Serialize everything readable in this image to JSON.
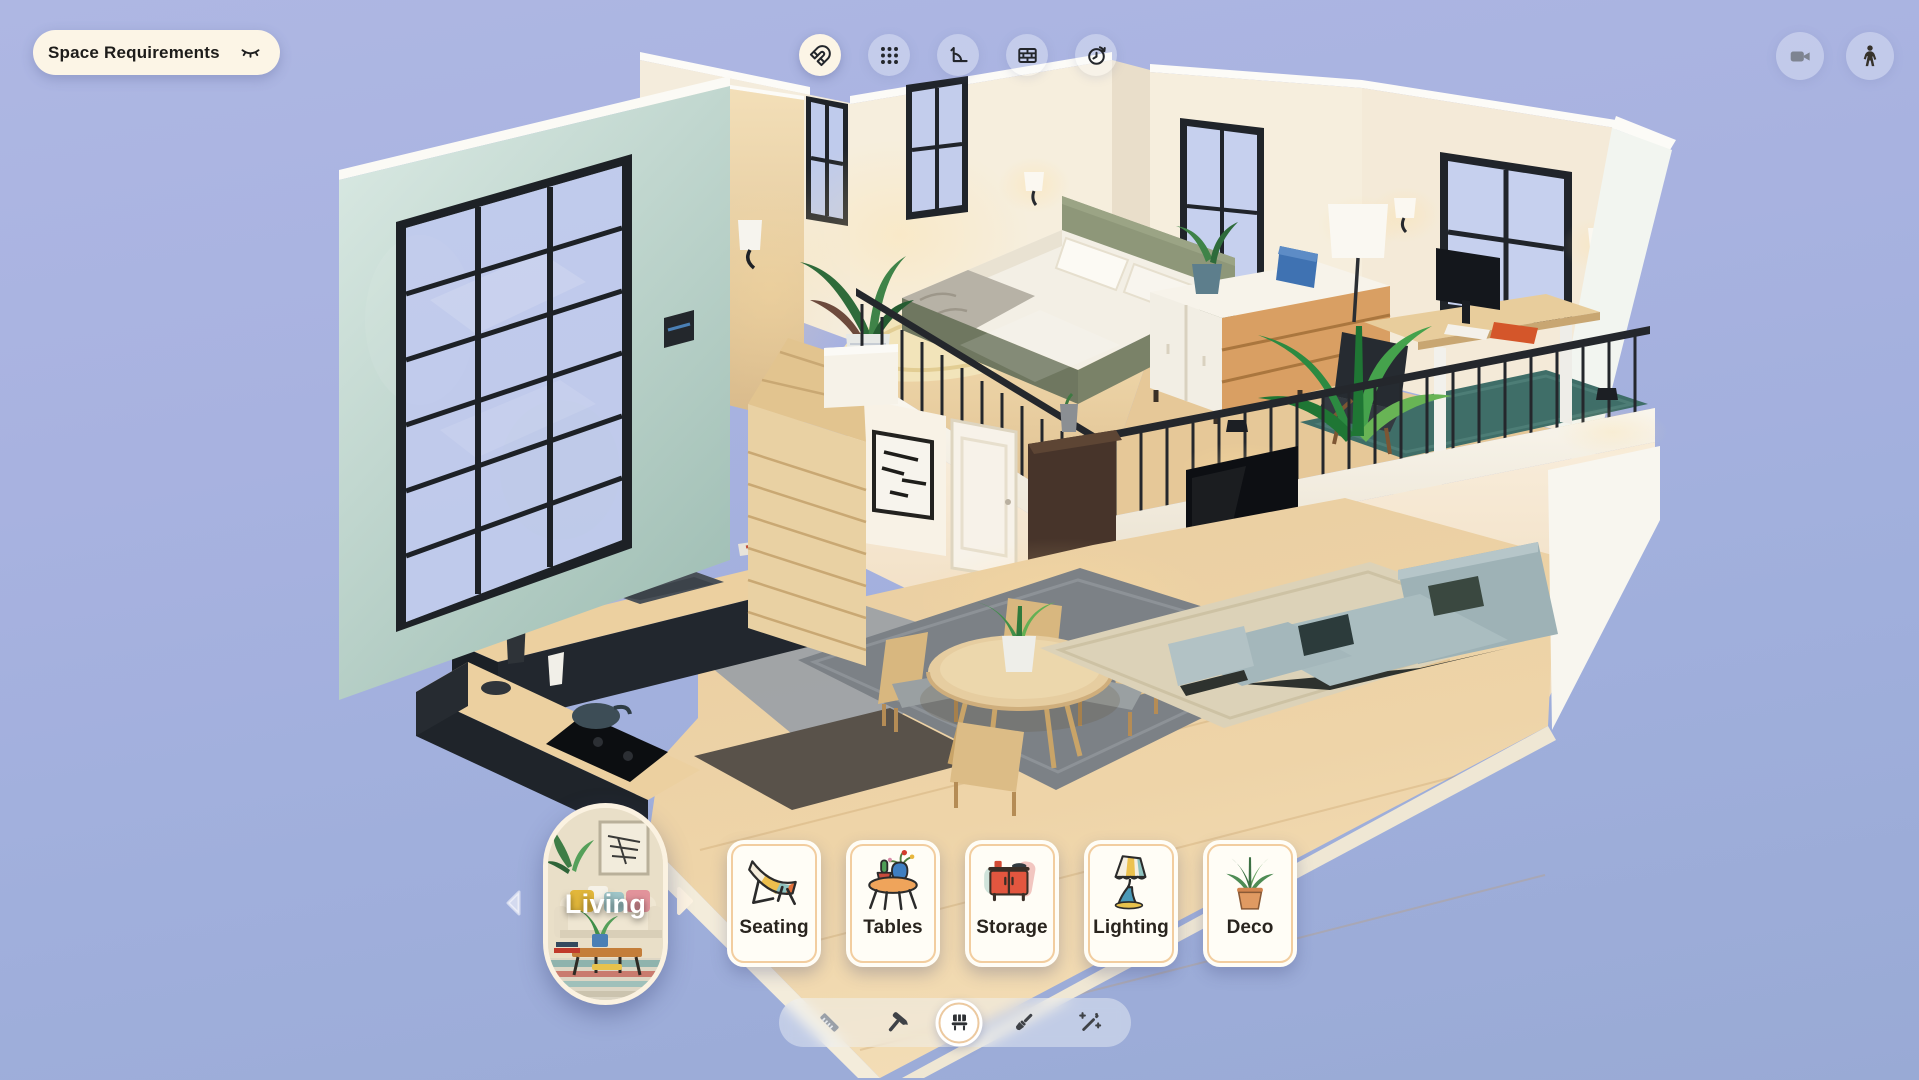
{
  "top_bar": {
    "space_requirements": {
      "label": "Space Requirements",
      "icon": "eye-closed"
    },
    "tools": [
      {
        "name": "snap",
        "icon": "magnet",
        "active": true
      },
      {
        "name": "layout-grid",
        "icon": "grid-dots",
        "active": false
      },
      {
        "name": "angle",
        "icon": "corner-angle",
        "active": false
      },
      {
        "name": "walls",
        "icon": "brick-wall",
        "active": false
      },
      {
        "name": "history",
        "icon": "clock-arrow",
        "active": false
      }
    ],
    "view_controls": [
      {
        "name": "camera-view",
        "icon": "video-camera"
      },
      {
        "name": "walk-mode",
        "icon": "person"
      }
    ]
  },
  "category_bar": {
    "room": {
      "label": "Living"
    },
    "prev": {
      "icon": "chevron-left"
    },
    "next": {
      "icon": "chevron-right"
    },
    "categories": [
      {
        "label": "Seating",
        "icon": "lounge-chair"
      },
      {
        "label": "Tables",
        "icon": "round-table"
      },
      {
        "label": "Storage",
        "icon": "cabinet"
      },
      {
        "label": "Lighting",
        "icon": "table-lamp"
      },
      {
        "label": "Deco",
        "icon": "potted-plant"
      }
    ]
  },
  "mode_bar": {
    "modes": [
      {
        "name": "measure",
        "icon": "ruler",
        "state": "disabled"
      },
      {
        "name": "build",
        "icon": "hammer",
        "state": "default"
      },
      {
        "name": "furnish",
        "icon": "bench",
        "state": "active"
      },
      {
        "name": "paint",
        "icon": "paint-brush",
        "state": "default"
      },
      {
        "name": "auto-style",
        "icon": "magic-wand",
        "state": "default"
      }
    ]
  },
  "colors": {
    "background_top": "#aeb7e3",
    "background_bottom": "#99aad5",
    "cream": "#fcf5e6",
    "card_background": "#fffdf6",
    "card_border": "#f2cd9f",
    "icon_dark": "#23262b",
    "label_dark": "#29241e",
    "teal_wall": "#c2d8cf",
    "wood": "#e8cfa2",
    "sofa": "#a3b6ba"
  }
}
